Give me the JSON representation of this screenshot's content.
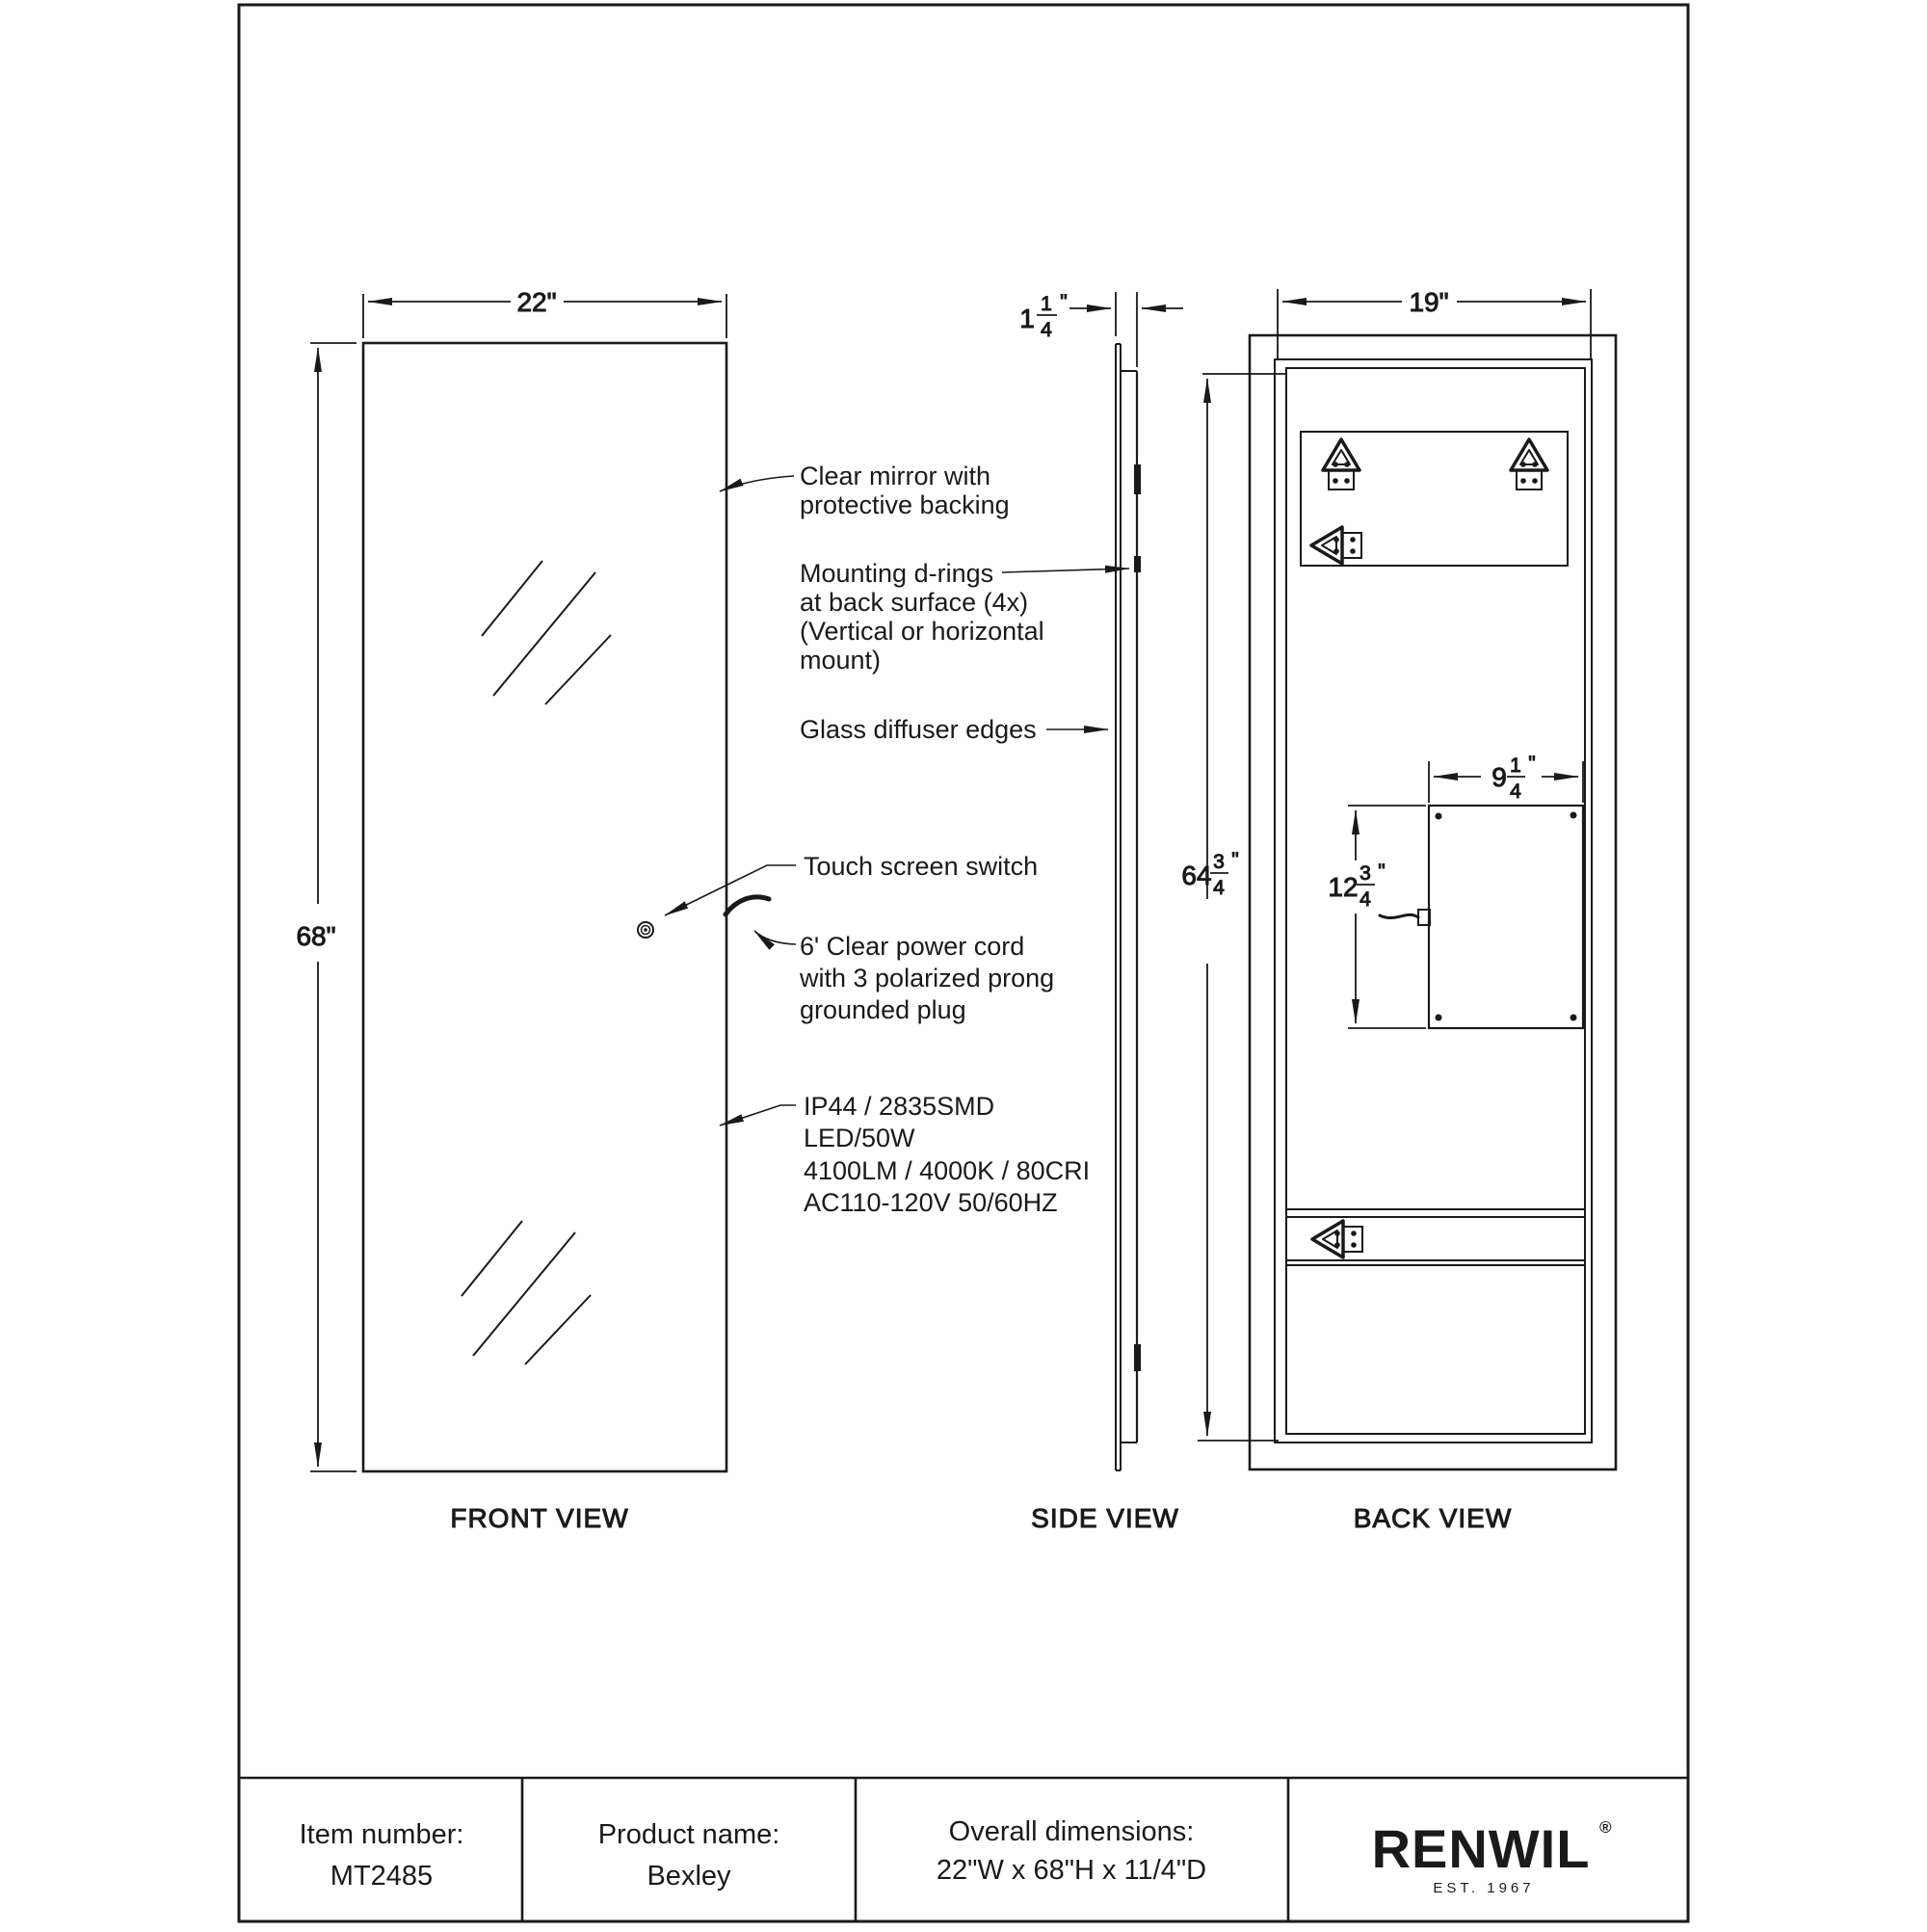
{
  "views": {
    "front": "FRONT VIEW",
    "side": "SIDE VIEW",
    "back": "BACK VIEW"
  },
  "dims": {
    "front_width": "22\"",
    "front_height": "68\"",
    "back_width": "19\"",
    "inch": "\"",
    "side_depth": {
      "whole": "1",
      "num": "1",
      "den": "4"
    },
    "back_height": {
      "whole": "64",
      "num": "3",
      "den": "4"
    },
    "jbox_width": {
      "whole": "9",
      "num": "1",
      "den": "4"
    },
    "jbox_height": {
      "whole": "12",
      "num": "3",
      "den": "4"
    }
  },
  "annotations": {
    "clear_mirror": [
      "Clear mirror with",
      "protective backing"
    ],
    "mounting_drings": [
      "Mounting d-rings",
      "at back surface (4x)",
      "(Vertical or horizontal",
      "mount)"
    ],
    "glass_diffuser": [
      "Glass diffuser edges"
    ],
    "touch_switch": [
      "Touch screen switch"
    ],
    "power_cord": [
      "6' Clear power cord",
      "with 3 polarized prong",
      "grounded plug"
    ],
    "led_specs": [
      "IP44 / 2835SMD",
      "LED/50W",
      "4100LM / 4000K / 80CRI",
      "AC110-120V 50/60HZ"
    ]
  },
  "title_block": {
    "item_number_label": "Item number:",
    "item_number": "MT2485",
    "product_name_label": "Product name:",
    "product_name": "Bexley",
    "dimensions_label": "Overall dimensions:",
    "dimensions": "22\"W x 68\"H x 11/4\"D",
    "brand": "RENWIL",
    "brand_reg": "®",
    "brand_est": "EST. 1967"
  },
  "colors": {
    "line": "#1a1a1a",
    "background": "#ffffff"
  }
}
